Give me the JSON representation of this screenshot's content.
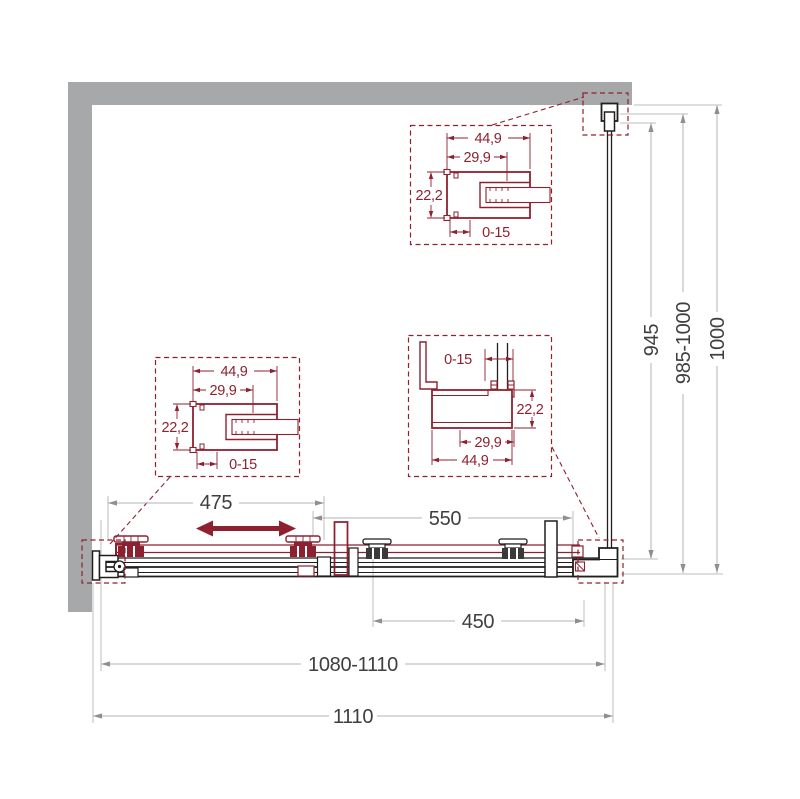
{
  "drawing": {
    "title": "shower-door-technical-drawing",
    "dims": {
      "door_width": "475",
      "fixed_width": "550",
      "entry_width": "450",
      "adjustable_width": "1080-1110",
      "total_width": "1110",
      "glass_depth": "945",
      "adjustable_depth": "985-1000",
      "total_depth": "1000"
    },
    "profile": {
      "outer": "44,9",
      "inner": "29,9",
      "depth": "22,2",
      "adjust": "0-15"
    },
    "colors": {
      "accent_maroon": "#8E2130",
      "wall_gray": "#A6A8AA",
      "dim_gray": "#B3B3B3",
      "text_dark": "#3F3F3F"
    }
  }
}
